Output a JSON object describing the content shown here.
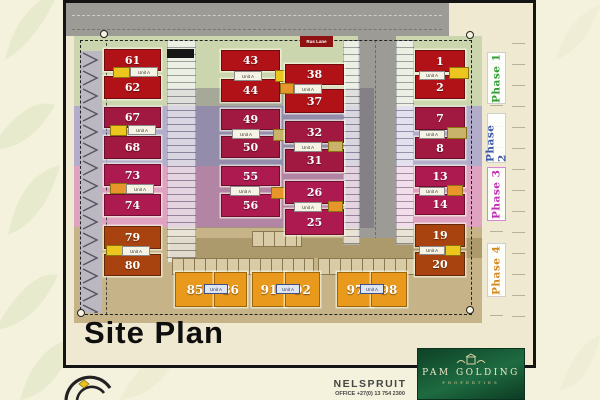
{
  "title": "Site Plan",
  "labels": {
    "lane": "Rus Lane",
    "unit": "Unit A"
  },
  "phases": [
    {
      "label": "Phase 1",
      "color": "#2f9e33"
    },
    {
      "label": "Phase 2",
      "color": "#3c57a8"
    },
    {
      "label": "Phase 3",
      "color": "#c12bb5"
    },
    {
      "label": "Phase 4",
      "color": "#d4881c"
    }
  ],
  "stands": [
    "61",
    "62",
    "67",
    "68",
    "73",
    "74",
    "79",
    "80",
    "43",
    "44",
    "49",
    "50",
    "55",
    "56",
    "38",
    "37",
    "32",
    "31",
    "26",
    "25",
    "1",
    "2",
    "7",
    "8",
    "13",
    "14",
    "19",
    "20",
    "85",
    "86",
    "91",
    "92",
    "97",
    "98"
  ],
  "stand_colors": {
    "phase1_house": "#b01217",
    "phase2_house": "#a11840",
    "phase3_house": "#ad1a50",
    "phase4_house": "#a8430f",
    "orange_unit": "#e9991c"
  },
  "footer": {
    "location": "NELSPRUIT",
    "office": "OFFICE +27(0) 13 754 2300",
    "brand": "PAM GOLDING",
    "brand_sub": "PROPERTIES",
    "brand_bg": "#14512f"
  }
}
